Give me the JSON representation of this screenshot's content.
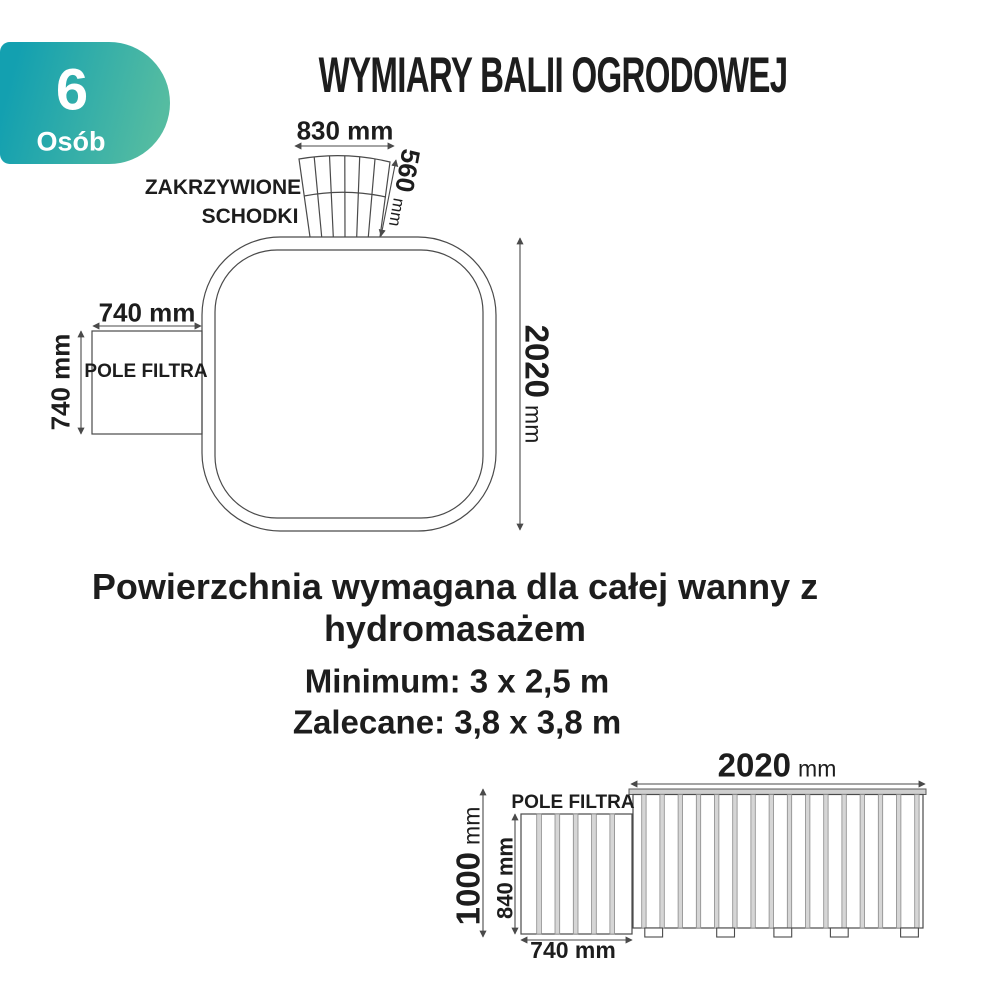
{
  "badge": {
    "number": "6",
    "label": "Osób",
    "gradient_start": "#13a0b0",
    "gradient_end": "#55bca1"
  },
  "title": "WYMIARY BALII OGRODOWEJ",
  "top_view": {
    "steps_label_line1": "ZAKRZYWIONE",
    "steps_label_line2": "SCHODKI",
    "steps_width": "830 mm",
    "steps_depth": {
      "value": "560",
      "unit": "mm"
    },
    "filter_width": "740 mm",
    "filter_depth": "740 mm",
    "filter_label": "POLE FILTRA",
    "tub_length": {
      "value": "2020",
      "unit": "mm"
    }
  },
  "area_note": {
    "heading_line1": "Powierzchnia wymagana dla całej wanny z",
    "heading_line2": "hydromasażem",
    "minimum": "Minimum: 3 x 2,5 m",
    "recommended": "Zalecane: 3,8 x 3,8 m"
  },
  "side_view": {
    "filter_label": "POLE FILTRA",
    "tub_length": {
      "value": "2020",
      "unit": "mm"
    },
    "total_height": {
      "value": "1000",
      "unit": "mm"
    },
    "filter_height": "840 mm",
    "filter_width": "740 mm"
  },
  "text_color": "#1d1d1d",
  "line_color": "#4a4a4a"
}
